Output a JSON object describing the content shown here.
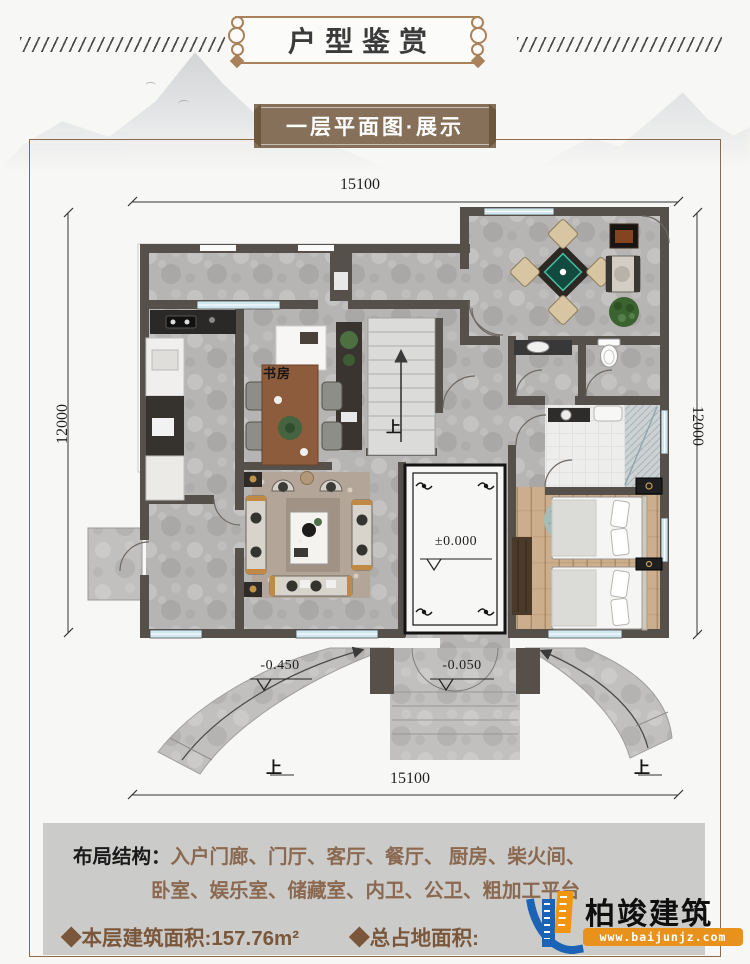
{
  "header": {
    "title": "户型鉴赏"
  },
  "subtitle": {
    "label": "一层平面图·展示"
  },
  "plan": {
    "dim_top": "15100",
    "dim_bottom": "15100",
    "dim_left": "12000",
    "dim_right": "12000",
    "room_study": "书房",
    "level_entry": "±0.000",
    "level_left": "-0.450",
    "level_center": "-0.050",
    "up_stairs": "上",
    "up_left": "上",
    "up_right": "上"
  },
  "info": {
    "layout_label": "布局结构：",
    "layout_line1": "入户门廊、门厅、客厅、餐厅、 厨房、柴火间、",
    "layout_line2": "卧室、娱乐室、储藏室、内卫、公卫、粗加工平台",
    "area_floor": "◆本层建筑面积:157.76m²",
    "area_total": "◆总占地面积:"
  },
  "logo": {
    "name": "柏竣建筑",
    "website": "www.baijunjz.com"
  },
  "colors": {
    "accent_brown": "#8a6950",
    "banner_brown": "#87705a",
    "frame_brown": "#a9825a",
    "wall": "#56504a",
    "window_blue": "#cfe7ee",
    "logo_blue": "#1b63b5",
    "logo_orange": "#f0950f"
  }
}
